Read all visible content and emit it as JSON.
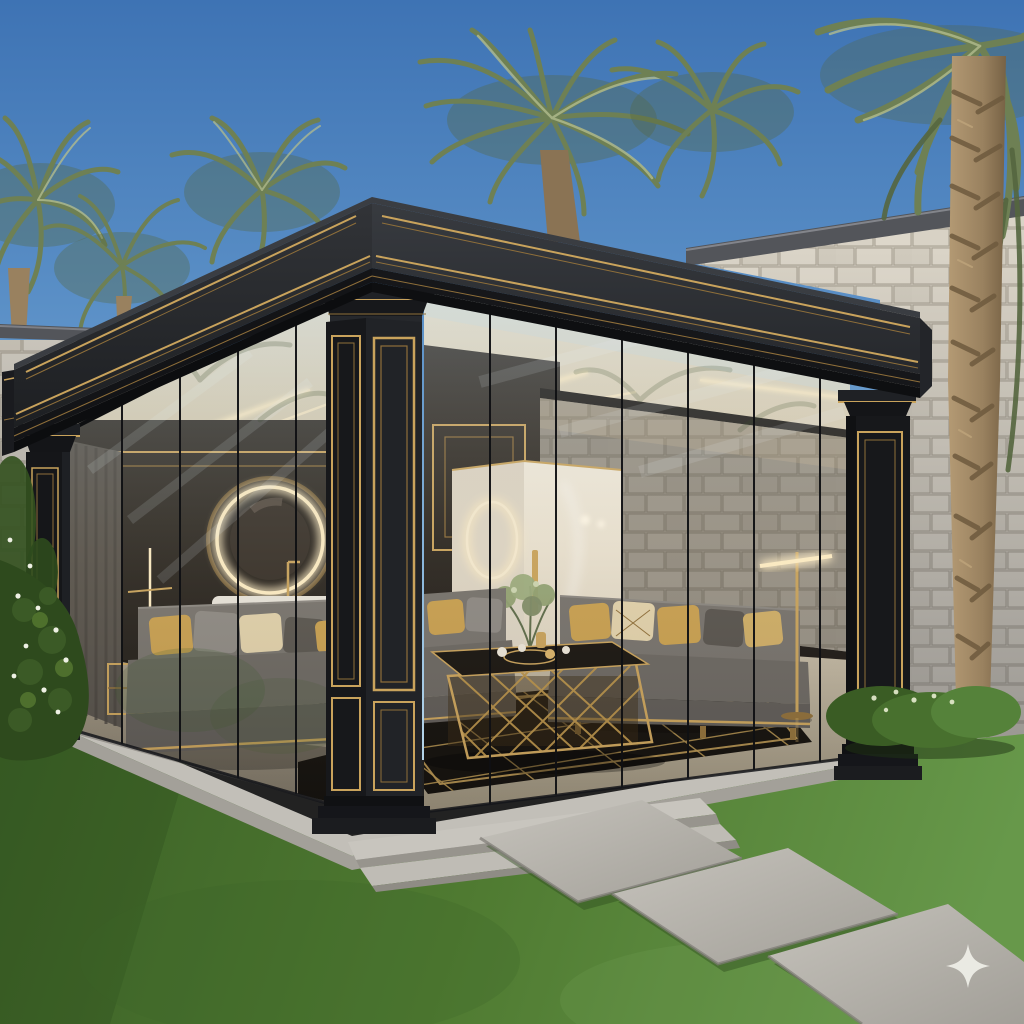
{
  "scene": {
    "description": "Photorealistic dusk render of a luxury black-and-gold glass pavilion lounge in a landscaped backyard with palm trees, white stone garden walls, a green lawn and concrete stepping stones",
    "time_of_day": "dusk",
    "watermark": {
      "icon": "sparkle-star-icon",
      "color": "#f2f2ec"
    },
    "objects": [
      "blue dusk sky",
      "fan palm trees",
      "large fibrous palm trunk",
      "white stone block garden walls",
      "black pavilion roof with gold pinstripe cornice",
      "black columns with double gold panel frames",
      "frameless glass walls",
      "cream ceiling with linear LED light strips",
      "illuminated round mirror",
      "white vanity basin with gold faucet",
      "frosted glass cabinet with ring light and gold handle",
      "grey velvet sofas with gold sequin pillows",
      "gold openwork coffee table with tea set",
      "black rug with gold geometric lattice",
      "gold floor lamp with glowing bar",
      "grey curtain",
      "decorative plant in gold vase",
      "concrete platform with steps",
      "rectangular concrete stepping stones",
      "green lawn",
      "flowering hedge and shrubs",
      "sparkle watermark"
    ]
  },
  "colors": {
    "sky_top": "#3e73b4",
    "sky_mid": "#5d92c8",
    "sky_low": "#8db9dd",
    "sky_horizon": "#b3d3e8",
    "palm_dark": "#55663f",
    "palm_mid": "#6e8054",
    "palm_light": "#b2bc8e",
    "trunk_light": "#b49a74",
    "trunk_mid": "#99815f",
    "trunk_dark": "#6e5a3e",
    "stone1": "#d3cec3",
    "stone2": "#c9c3b6",
    "stone_joint": "#a19a8c",
    "coping": "#53555a",
    "black": "#151619",
    "roof_face": "#2b2d31",
    "gold": "#c9a35c",
    "gold_dim": "#8f6f3a",
    "gold_bright": "#ecd29a",
    "glow": "#ffeec6",
    "ceiling": "#e4dbc6",
    "strip": "#f7e7c4",
    "marble": "#2e2a26",
    "cabinet": "#ece5d7",
    "sofa": "#76726d",
    "seat": "#6b6762",
    "skirt": "#5f5b57",
    "pillow_gold": "#c9a050",
    "pillow_pale": "#e2d2ac",
    "pillow_dark": "#57534e",
    "rug": "#14110d",
    "rug_line": "#b99753",
    "floor_in": "#c3b9a7",
    "concrete": "#c2bfb8",
    "concrete_dark": "#a3a099",
    "grass_dark": "#3a5f26",
    "grass_mid": "#4f7a31",
    "grass_light": "#67984a",
    "hedge": "#2e4a1d",
    "flower": "#eef0e4",
    "watermark": "#f2f2ec"
  }
}
